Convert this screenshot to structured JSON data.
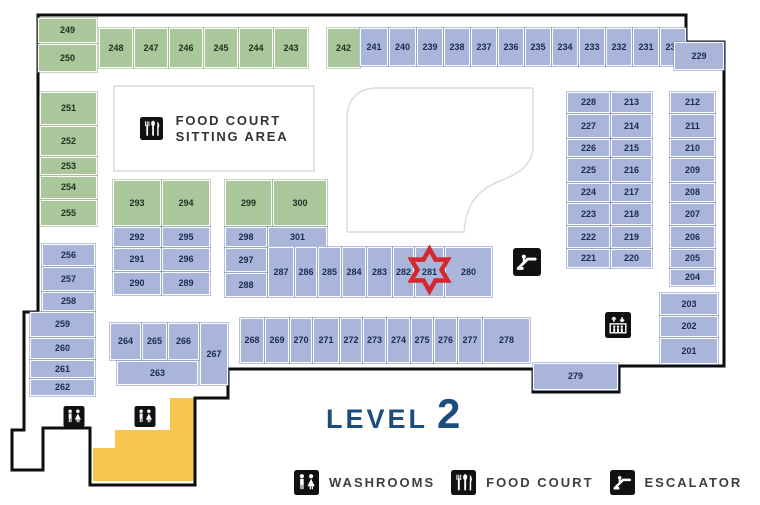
{
  "title": {
    "level_label": "LEVEL",
    "level_number": "2"
  },
  "colors": {
    "unit_green": "#a9c79a",
    "unit_blue": "#a9b5d9",
    "stairs_yellow": "#f9c64d",
    "marker_red": "#d4282e",
    "level_text": "#1d4d7c",
    "outline_black": "#0d0d0d"
  },
  "marker": {
    "unit": "281",
    "shape": "six-point-star",
    "color": "#d4282e"
  },
  "food_court_area": {
    "icon": "food-court-icon",
    "line1": "FOOD COURT",
    "line2": "SITTING AREA"
  },
  "legend": {
    "items": [
      {
        "icon": "washrooms-icon",
        "label": "WASHROOMS"
      },
      {
        "icon": "food-court-icon",
        "label": "FOOD COURT"
      },
      {
        "icon": "escalator-icon",
        "label": "ESCALATOR"
      }
    ]
  },
  "map": {
    "units": [
      {
        "n": "249",
        "x": 38,
        "y": 18,
        "w": 59,
        "h": 25,
        "c": "g"
      },
      {
        "n": "250",
        "x": 38,
        "y": 44,
        "w": 59,
        "h": 28,
        "c": "g"
      },
      {
        "n": "251",
        "x": 40,
        "y": 92,
        "w": 57,
        "h": 33,
        "c": "g"
      },
      {
        "n": "252",
        "x": 40,
        "y": 126,
        "w": 57,
        "h": 30,
        "c": "g"
      },
      {
        "n": "253",
        "x": 40,
        "y": 157,
        "w": 57,
        "h": 18,
        "c": "g"
      },
      {
        "n": "254",
        "x": 40,
        "y": 176,
        "w": 57,
        "h": 23,
        "c": "g"
      },
      {
        "n": "255",
        "x": 40,
        "y": 200,
        "w": 57,
        "h": 26,
        "c": "g"
      },
      {
        "n": "256",
        "x": 42,
        "y": 244,
        "w": 53,
        "h": 22,
        "c": "b"
      },
      {
        "n": "257",
        "x": 42,
        "y": 267,
        "w": 53,
        "h": 24,
        "c": "b"
      },
      {
        "n": "258",
        "x": 42,
        "y": 292,
        "w": 53,
        "h": 19,
        "c": "b"
      },
      {
        "n": "259",
        "x": 30,
        "y": 312,
        "w": 65,
        "h": 25,
        "c": "b"
      },
      {
        "n": "260",
        "x": 30,
        "y": 338,
        "w": 65,
        "h": 21,
        "c": "b"
      },
      {
        "n": "261",
        "x": 30,
        "y": 360,
        "w": 65,
        "h": 18,
        "c": "b"
      },
      {
        "n": "262",
        "x": 30,
        "y": 379,
        "w": 65,
        "h": 17,
        "c": "b"
      },
      {
        "n": "248",
        "x": 99,
        "y": 28,
        "w": 34,
        "h": 40,
        "c": "g"
      },
      {
        "n": "247",
        "x": 134,
        "y": 28,
        "w": 34,
        "h": 40,
        "c": "g"
      },
      {
        "n": "246",
        "x": 169,
        "y": 28,
        "w": 34,
        "h": 40,
        "c": "g"
      },
      {
        "n": "245",
        "x": 204,
        "y": 28,
        "w": 34,
        "h": 40,
        "c": "g"
      },
      {
        "n": "244",
        "x": 239,
        "y": 28,
        "w": 34,
        "h": 40,
        "c": "g"
      },
      {
        "n": "243",
        "x": 274,
        "y": 28,
        "w": 34,
        "h": 40,
        "c": "g"
      },
      {
        "n": "242",
        "x": 327,
        "y": 28,
        "w": 33,
        "h": 40,
        "c": "g"
      },
      {
        "n": "241",
        "x": 360,
        "y": 28,
        "w": 28,
        "h": 38,
        "c": "b"
      },
      {
        "n": "240",
        "x": 389,
        "y": 28,
        "w": 27,
        "h": 38,
        "c": "b"
      },
      {
        "n": "239",
        "x": 417,
        "y": 28,
        "w": 26,
        "h": 38,
        "c": "b"
      },
      {
        "n": "238",
        "x": 444,
        "y": 28,
        "w": 26,
        "h": 38,
        "c": "b"
      },
      {
        "n": "237",
        "x": 471,
        "y": 28,
        "w": 26,
        "h": 38,
        "c": "b"
      },
      {
        "n": "236",
        "x": 498,
        "y": 28,
        "w": 26,
        "h": 38,
        "c": "b"
      },
      {
        "n": "235",
        "x": 525,
        "y": 28,
        "w": 26,
        "h": 38,
        "c": "b"
      },
      {
        "n": "234",
        "x": 552,
        "y": 28,
        "w": 26,
        "h": 38,
        "c": "b"
      },
      {
        "n": "233",
        "x": 579,
        "y": 28,
        "w": 26,
        "h": 38,
        "c": "b"
      },
      {
        "n": "232",
        "x": 606,
        "y": 28,
        "w": 26,
        "h": 38,
        "c": "b"
      },
      {
        "n": "231",
        "x": 633,
        "y": 28,
        "w": 26,
        "h": 38,
        "c": "b"
      },
      {
        "n": "230",
        "x": 660,
        "y": 28,
        "w": 26,
        "h": 38,
        "c": "b"
      },
      {
        "n": "229",
        "x": 674,
        "y": 42,
        "w": 50,
        "h": 28,
        "c": "b"
      },
      {
        "n": "228",
        "x": 567,
        "y": 92,
        "w": 43,
        "h": 21,
        "c": "b"
      },
      {
        "n": "213",
        "x": 611,
        "y": 92,
        "w": 41,
        "h": 21,
        "c": "b"
      },
      {
        "n": "227",
        "x": 567,
        "y": 114,
        "w": 43,
        "h": 24,
        "c": "b"
      },
      {
        "n": "214",
        "x": 611,
        "y": 114,
        "w": 41,
        "h": 24,
        "c": "b"
      },
      {
        "n": "226",
        "x": 567,
        "y": 139,
        "w": 43,
        "h": 18,
        "c": "b"
      },
      {
        "n": "215",
        "x": 611,
        "y": 139,
        "w": 41,
        "h": 18,
        "c": "b"
      },
      {
        "n": "225",
        "x": 567,
        "y": 158,
        "w": 43,
        "h": 24,
        "c": "b"
      },
      {
        "n": "216",
        "x": 611,
        "y": 158,
        "w": 41,
        "h": 24,
        "c": "b"
      },
      {
        "n": "224",
        "x": 567,
        "y": 183,
        "w": 43,
        "h": 19,
        "c": "b"
      },
      {
        "n": "217",
        "x": 611,
        "y": 183,
        "w": 41,
        "h": 19,
        "c": "b"
      },
      {
        "n": "223",
        "x": 567,
        "y": 203,
        "w": 43,
        "h": 22,
        "c": "b"
      },
      {
        "n": "218",
        "x": 611,
        "y": 203,
        "w": 41,
        "h": 22,
        "c": "b"
      },
      {
        "n": "222",
        "x": 567,
        "y": 226,
        "w": 43,
        "h": 22,
        "c": "b"
      },
      {
        "n": "219",
        "x": 611,
        "y": 226,
        "w": 41,
        "h": 22,
        "c": "b"
      },
      {
        "n": "221",
        "x": 567,
        "y": 249,
        "w": 43,
        "h": 19,
        "c": "b"
      },
      {
        "n": "220",
        "x": 611,
        "y": 249,
        "w": 41,
        "h": 19,
        "c": "b"
      },
      {
        "n": "212",
        "x": 670,
        "y": 92,
        "w": 45,
        "h": 21,
        "c": "b"
      },
      {
        "n": "211",
        "x": 670,
        "y": 114,
        "w": 45,
        "h": 24,
        "c": "b"
      },
      {
        "n": "210",
        "x": 670,
        "y": 139,
        "w": 45,
        "h": 18,
        "c": "b"
      },
      {
        "n": "209",
        "x": 670,
        "y": 158,
        "w": 45,
        "h": 24,
        "c": "b"
      },
      {
        "n": "208",
        "x": 670,
        "y": 183,
        "w": 45,
        "h": 19,
        "c": "b"
      },
      {
        "n": "207",
        "x": 670,
        "y": 203,
        "w": 45,
        "h": 22,
        "c": "b"
      },
      {
        "n": "206",
        "x": 670,
        "y": 226,
        "w": 45,
        "h": 22,
        "c": "b"
      },
      {
        "n": "205",
        "x": 670,
        "y": 249,
        "w": 45,
        "h": 19,
        "c": "b"
      },
      {
        "n": "204",
        "x": 670,
        "y": 269,
        "w": 45,
        "h": 17,
        "c": "b"
      },
      {
        "n": "203",
        "x": 660,
        "y": 293,
        "w": 58,
        "h": 22,
        "c": "b"
      },
      {
        "n": "202",
        "x": 660,
        "y": 316,
        "w": 58,
        "h": 21,
        "c": "b"
      },
      {
        "n": "201",
        "x": 660,
        "y": 338,
        "w": 58,
        "h": 26,
        "c": "b"
      },
      {
        "n": "293",
        "x": 113,
        "y": 180,
        "w": 48,
        "h": 46,
        "c": "g"
      },
      {
        "n": "294",
        "x": 162,
        "y": 180,
        "w": 48,
        "h": 46,
        "c": "g"
      },
      {
        "n": "292",
        "x": 113,
        "y": 227,
        "w": 48,
        "h": 20,
        "c": "b"
      },
      {
        "n": "295",
        "x": 162,
        "y": 227,
        "w": 48,
        "h": 20,
        "c": "b"
      },
      {
        "n": "291",
        "x": 113,
        "y": 248,
        "w": 48,
        "h": 23,
        "c": "b"
      },
      {
        "n": "296",
        "x": 162,
        "y": 248,
        "w": 48,
        "h": 23,
        "c": "b"
      },
      {
        "n": "290",
        "x": 113,
        "y": 272,
        "w": 48,
        "h": 23,
        "c": "b"
      },
      {
        "n": "289",
        "x": 162,
        "y": 272,
        "w": 48,
        "h": 23,
        "c": "b"
      },
      {
        "n": "299",
        "x": 225,
        "y": 180,
        "w": 47,
        "h": 46,
        "c": "g"
      },
      {
        "n": "300",
        "x": 273,
        "y": 180,
        "w": 54,
        "h": 46,
        "c": "g"
      },
      {
        "n": "298",
        "x": 225,
        "y": 227,
        "w": 42,
        "h": 20,
        "c": "b"
      },
      {
        "n": "301",
        "x": 268,
        "y": 227,
        "w": 59,
        "h": 20,
        "c": "b"
      },
      {
        "n": "297",
        "x": 225,
        "y": 248,
        "w": 42,
        "h": 24,
        "c": "b"
      },
      {
        "n": "288",
        "x": 225,
        "y": 273,
        "w": 42,
        "h": 24,
        "c": "b"
      },
      {
        "n": "287",
        "x": 268,
        "y": 247,
        "w": 26,
        "h": 50,
        "c": "b"
      },
      {
        "n": "286",
        "x": 295,
        "y": 247,
        "w": 22,
        "h": 50,
        "c": "b"
      },
      {
        "n": "285",
        "x": 318,
        "y": 247,
        "w": 23,
        "h": 50,
        "c": "b"
      },
      {
        "n": "284",
        "x": 342,
        "y": 247,
        "w": 24,
        "h": 50,
        "c": "b"
      },
      {
        "n": "283",
        "x": 367,
        "y": 247,
        "w": 25,
        "h": 50,
        "c": "b"
      },
      {
        "n": "282",
        "x": 393,
        "y": 247,
        "w": 21,
        "h": 50,
        "c": "b"
      },
      {
        "n": "281",
        "x": 415,
        "y": 247,
        "w": 29,
        "h": 50,
        "c": "b"
      },
      {
        "n": "280",
        "x": 445,
        "y": 247,
        "w": 47,
        "h": 50,
        "c": "b"
      },
      {
        "n": "264",
        "x": 110,
        "y": 323,
        "w": 31,
        "h": 37,
        "c": "b"
      },
      {
        "n": "265",
        "x": 142,
        "y": 323,
        "w": 25,
        "h": 37,
        "c": "b"
      },
      {
        "n": "266",
        "x": 168,
        "y": 323,
        "w": 31,
        "h": 37,
        "c": "b"
      },
      {
        "n": "267",
        "x": 200,
        "y": 323,
        "w": 28,
        "h": 62,
        "c": "b"
      },
      {
        "n": "263",
        "x": 117,
        "y": 361,
        "w": 81,
        "h": 24,
        "c": "b"
      },
      {
        "n": "268",
        "x": 240,
        "y": 318,
        "w": 24,
        "h": 45,
        "c": "b"
      },
      {
        "n": "269",
        "x": 265,
        "y": 318,
        "w": 24,
        "h": 45,
        "c": "b"
      },
      {
        "n": "270",
        "x": 290,
        "y": 318,
        "w": 22,
        "h": 45,
        "c": "b"
      },
      {
        "n": "271",
        "x": 313,
        "y": 318,
        "w": 26,
        "h": 45,
        "c": "b"
      },
      {
        "n": "272",
        "x": 340,
        "y": 318,
        "w": 22,
        "h": 45,
        "c": "b"
      },
      {
        "n": "273",
        "x": 363,
        "y": 318,
        "w": 23,
        "h": 45,
        "c": "b"
      },
      {
        "n": "274",
        "x": 387,
        "y": 318,
        "w": 23,
        "h": 45,
        "c": "b"
      },
      {
        "n": "275",
        "x": 411,
        "y": 318,
        "w": 22,
        "h": 45,
        "c": "b"
      },
      {
        "n": "276",
        "x": 434,
        "y": 318,
        "w": 23,
        "h": 45,
        "c": "b"
      },
      {
        "n": "277",
        "x": 458,
        "y": 318,
        "w": 24,
        "h": 45,
        "c": "b"
      },
      {
        "n": "278",
        "x": 483,
        "y": 318,
        "w": 47,
        "h": 45,
        "c": "b"
      },
      {
        "n": "279",
        "x": 533,
        "y": 363,
        "w": 85,
        "h": 27,
        "c": "b"
      }
    ],
    "icons": [
      {
        "name": "washrooms-icon",
        "x": 63,
        "y": 406,
        "w": 22,
        "h": 21
      },
      {
        "name": "washrooms-icon",
        "x": 134,
        "y": 406,
        "w": 22,
        "h": 21
      },
      {
        "name": "escalator-icon",
        "x": 513,
        "y": 248,
        "w": 28,
        "h": 28
      },
      {
        "name": "elevator-icon",
        "x": 604,
        "y": 312,
        "w": 28,
        "h": 26
      }
    ]
  }
}
